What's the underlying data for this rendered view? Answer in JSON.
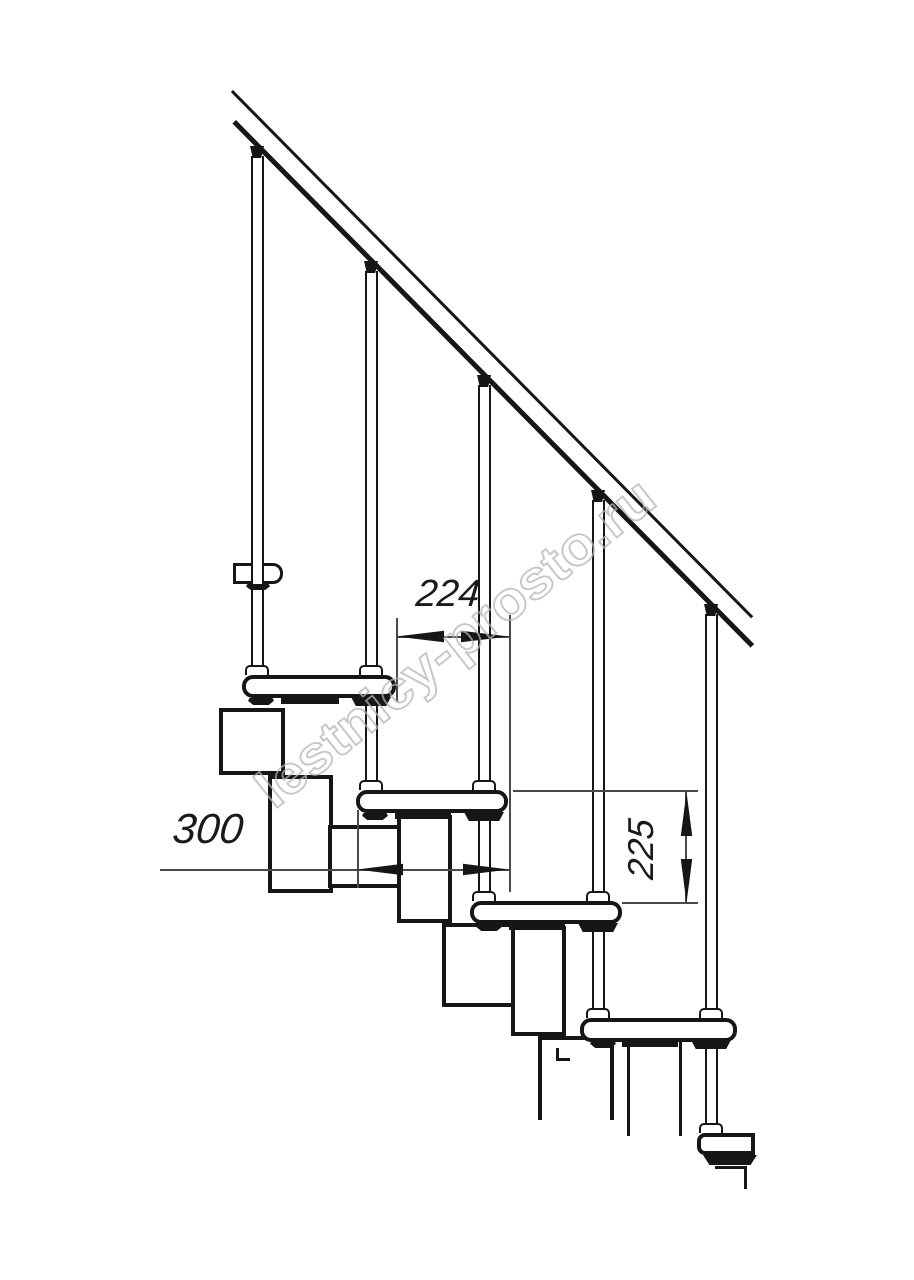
{
  "drawing": {
    "title": "modular staircase side-view technical drawing",
    "dimensions": {
      "run_label": "224",
      "depth_label": "300",
      "rise_label": "225"
    },
    "watermark": {
      "text": "lestnicy-prosto.ru"
    },
    "colors": {
      "line": "#161616",
      "dimension_line": "#4a4a4a",
      "watermark_stroke": "#b3b3b3",
      "background": "#ffffff"
    }
  }
}
